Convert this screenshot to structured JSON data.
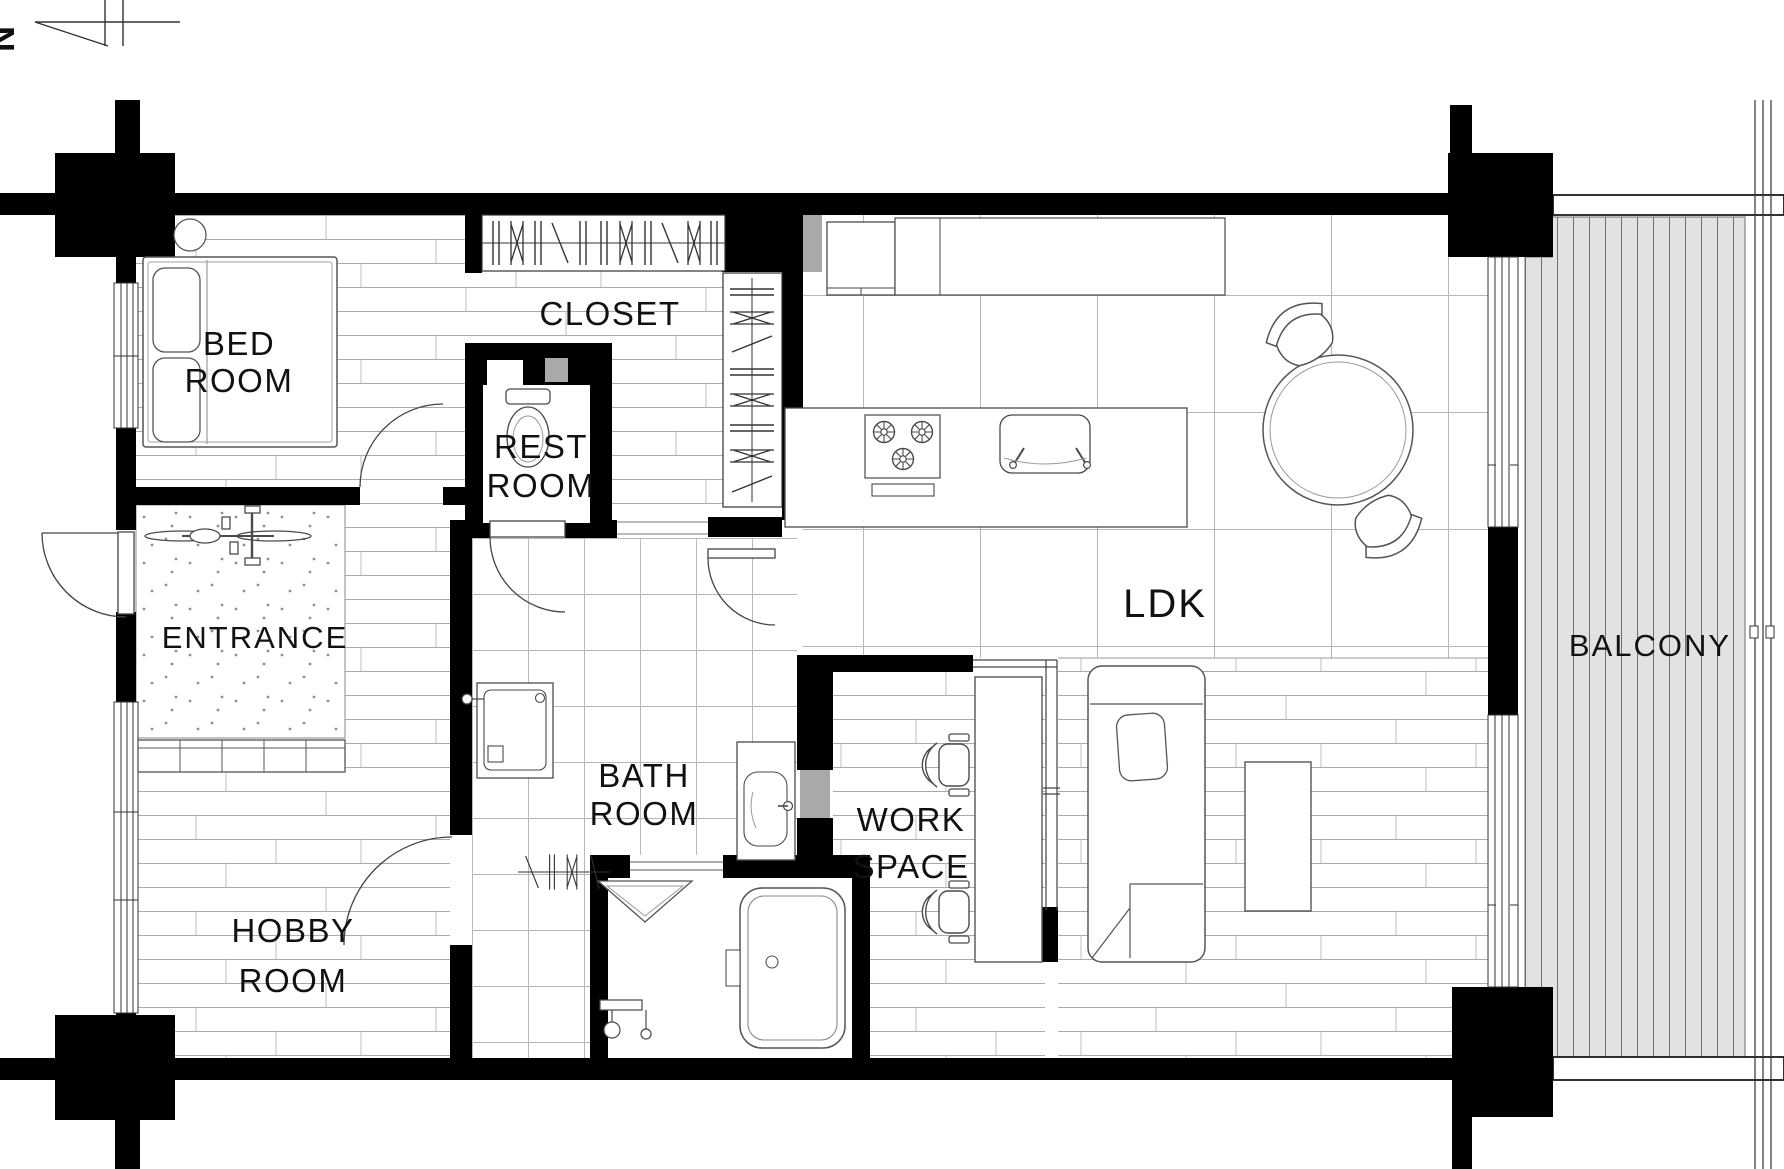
{
  "compass": {
    "label": "N"
  },
  "rooms": {
    "bedroom": {
      "line1": "BED",
      "line2": "ROOM"
    },
    "closet": {
      "label": "CLOSET"
    },
    "restroom": {
      "line1": "REST",
      "line2": "ROOM"
    },
    "entrance": {
      "label": "ENTRANCE"
    },
    "hobby": {
      "line1": "HOBBY",
      "line2": "ROOM"
    },
    "bath": {
      "line1": "BATH",
      "line2": "ROOM"
    },
    "work": {
      "line1": "WORK",
      "line2": "SPACE"
    },
    "ldk": {
      "label": "LDK"
    },
    "balcony": {
      "label": "BALCONY"
    }
  },
  "colors": {
    "wall": "#000000",
    "accent_gray": "#a9a9a9",
    "deck_fill": "#e2e2e2",
    "floor_line": "#a6a6a6",
    "furniture_line": "#4a4a4a"
  }
}
